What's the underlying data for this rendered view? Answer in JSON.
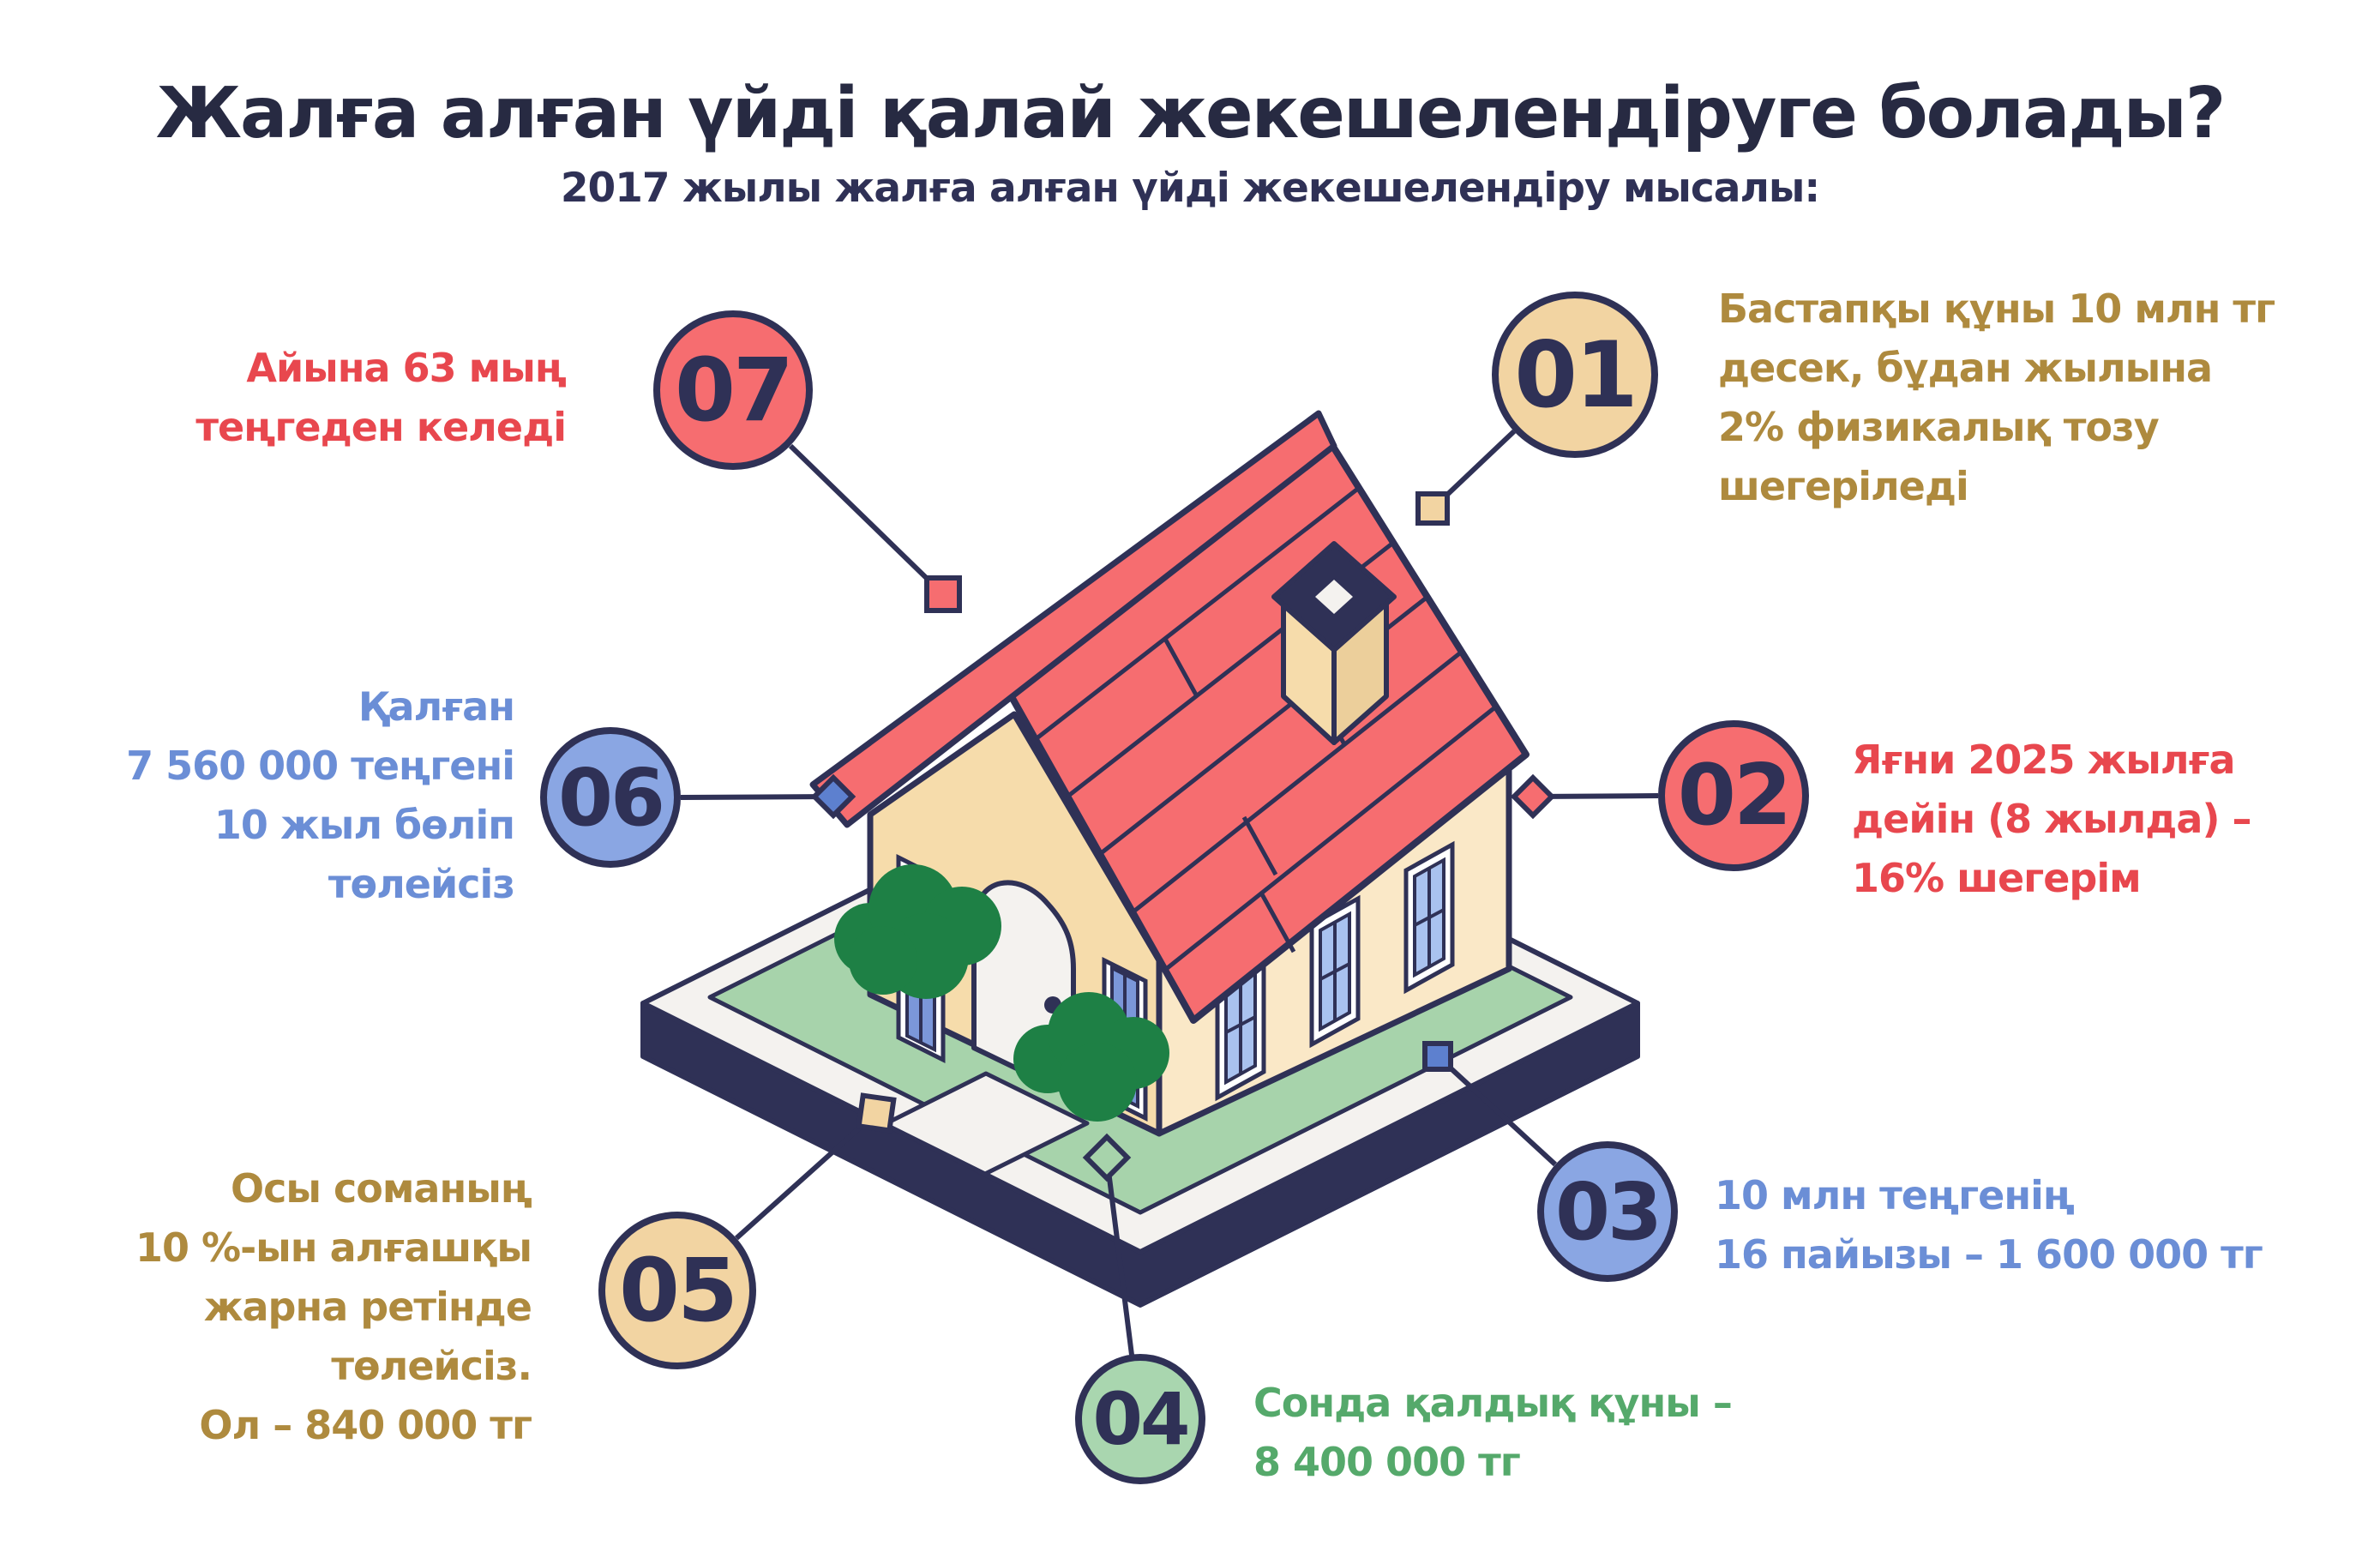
{
  "title": "Жалға алған үйді қалай жекешелендіруге болады?",
  "subtitle": "2017 жылы жалға алған үйді жекешелендіру мысалы:",
  "colors": {
    "navy": "#2f3156",
    "coral": "#f66d70",
    "tan": "#f2d4a2",
    "periwinkle": "#8aa6e3",
    "mint": "#a9d6af",
    "text_red": "#e8474e",
    "text_gold": "#ae8a3e",
    "text_blue": "#6b8ed6",
    "text_green": "#55a96b",
    "lawn": "#a7d3ab",
    "bush": "#1e8045",
    "wall": "#f6dcab",
    "platform_top": "#f4f2ef"
  },
  "steps": [
    {
      "num": "01",
      "text": "Бастапқы құны 10 млн тг\nдесек, бұдан жылына\n2% физикалық тозу\nшегеріледі"
    },
    {
      "num": "02",
      "text": "Яғни 2025 жылға\nдейін (8 жылда) –\n16% шегерім"
    },
    {
      "num": "03",
      "text": "10 млн теңгенің\n16 пайызы – 1 600 000 тг"
    },
    {
      "num": "04",
      "text": "Сонда қалдық құны –\n8 400 000 тг"
    },
    {
      "num": "05",
      "text": "Осы соманың\n10 %-ын алғашқы\nжарна ретінде\nтөлейсіз.\nОл – 840 000 тг"
    },
    {
      "num": "06",
      "text": "Қалған\n7 560 000 теңгені\n10 жыл бөліп\nтөлейсіз"
    },
    {
      "num": "07",
      "text": "Айына 63 мың\nтеңгеден келеді"
    }
  ]
}
